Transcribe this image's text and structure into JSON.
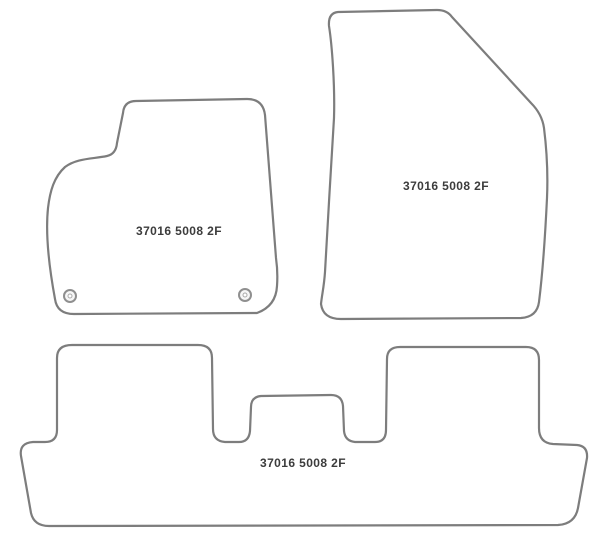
{
  "diagram": {
    "outline_color": "#7d7d7d",
    "label_color": "#3c3c3c",
    "background_color": "#ffffff",
    "mat_fill_color": "#ffffff",
    "mats": [
      {
        "name": "front-left-mat",
        "label": "37016 5008 2F",
        "fixing_clips": 2
      },
      {
        "name": "front-right-mat",
        "label": "37016 5008 2F",
        "fixing_clips": 0
      },
      {
        "name": "rear-bench-mat",
        "label": "37016 5008 2F",
        "fixing_clips": 0
      }
    ]
  }
}
